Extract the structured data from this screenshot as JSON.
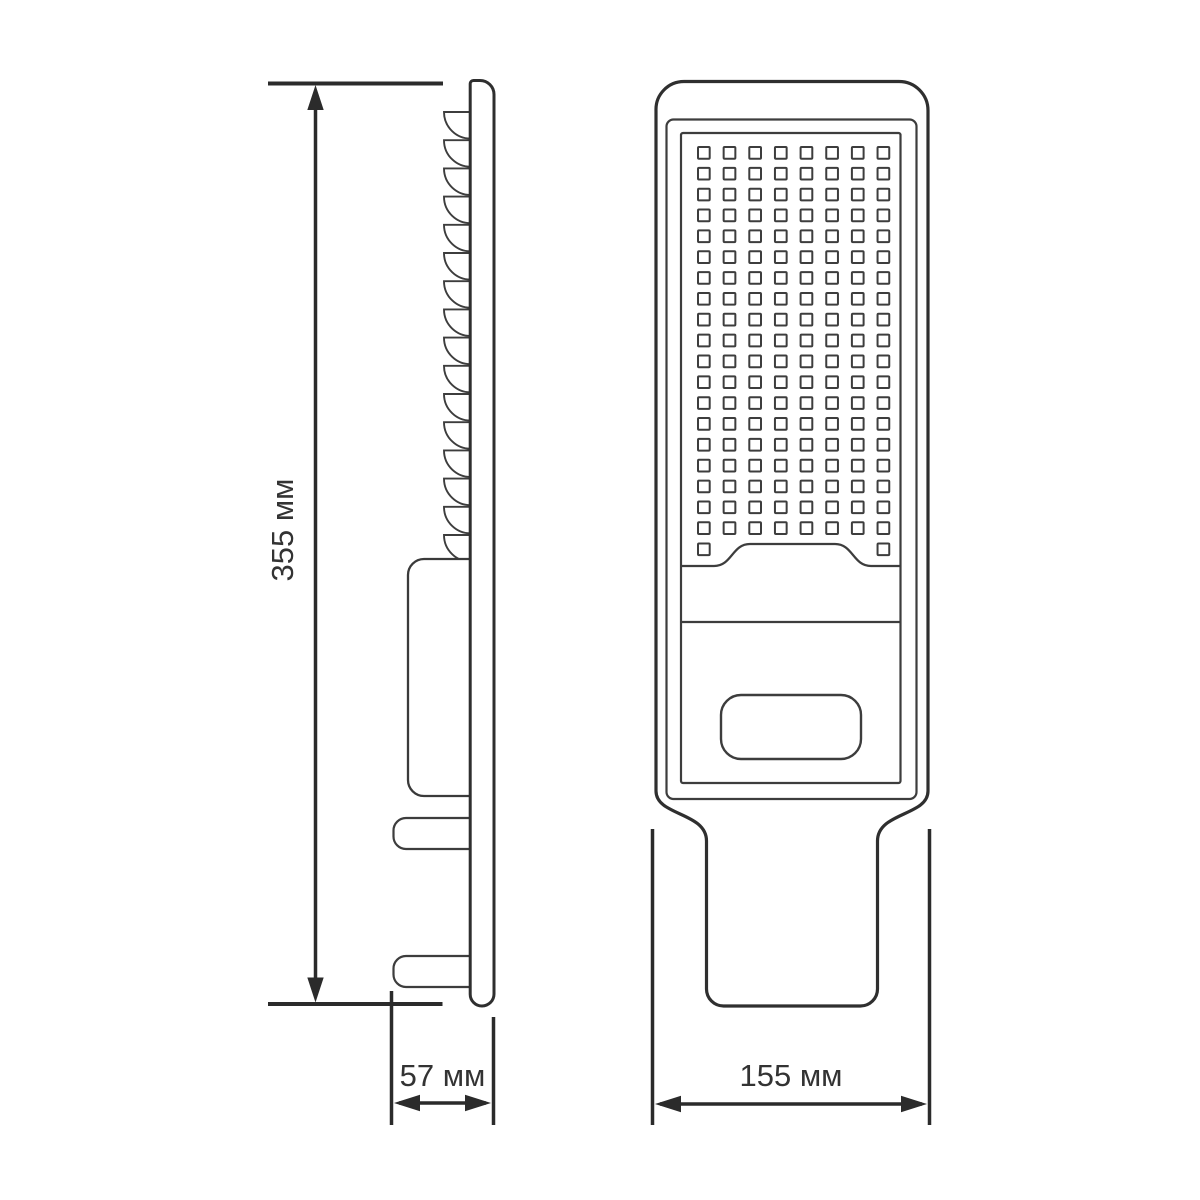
{
  "drawing": {
    "type": "technical-dimension-drawing",
    "subject": "LED street light luminaire, two orthographic views",
    "views": {
      "side": {
        "fins": 16,
        "mounting_tabs": 2
      },
      "front": {
        "led_columns": 8,
        "led_full_rows": 19,
        "led_partial_row_squares": 2
      }
    },
    "dimensions": {
      "height": {
        "label": "355 мм"
      },
      "depth": {
        "label": "57 мм"
      },
      "width": {
        "label": "155 мм"
      }
    },
    "colors": {
      "background": "#ffffff",
      "outline": "#2f2f2f",
      "thin_line": "#3d3d3d",
      "dimension": "#2b2b2b",
      "text": "#333333"
    }
  }
}
